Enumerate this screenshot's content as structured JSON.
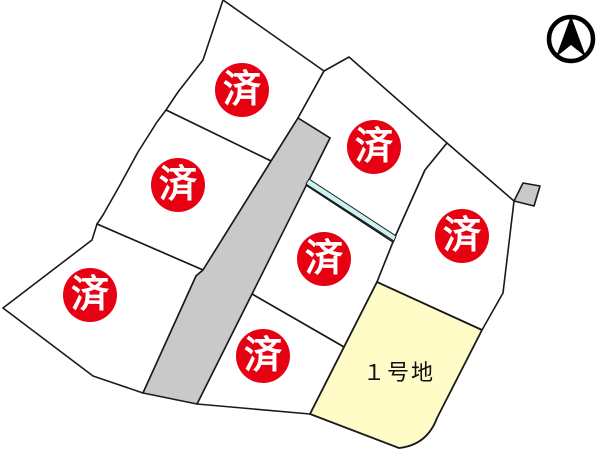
{
  "map": {
    "type": "land-subdivision-plot-map",
    "lots": [
      {
        "id": "lot-top-left",
        "status": "sold",
        "badge": "済"
      },
      {
        "id": "lot-top-middle",
        "status": "sold",
        "badge": "済"
      },
      {
        "id": "lot-left",
        "status": "sold",
        "badge": "済"
      },
      {
        "id": "lot-middle",
        "status": "sold",
        "badge": "済"
      },
      {
        "id": "lot-right",
        "status": "sold",
        "badge": "済"
      },
      {
        "id": "lot-bottom-left",
        "status": "sold",
        "badge": "済"
      },
      {
        "id": "lot-bottom-middle",
        "status": "sold",
        "badge": "済"
      },
      {
        "id": "lot-1",
        "status": "available",
        "label": "１号地"
      }
    ],
    "icons": {
      "compass": "north-arrow"
    }
  },
  "colors": {
    "sold_badge": "#e60012",
    "available_lot_fill": "#fffcc8",
    "road_fill": "#c9c9c9",
    "waterway_fill": "#cdf2f2",
    "boundary_line": "#1a1a1a"
  }
}
